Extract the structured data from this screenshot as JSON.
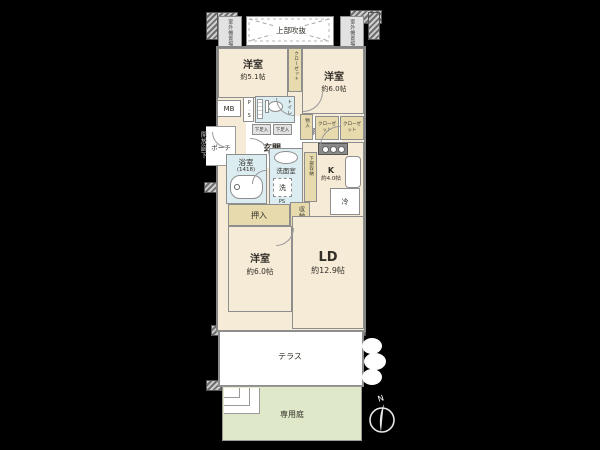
{
  "colors": {
    "background": "#000000",
    "room_floor": "#f6ebd7",
    "wet_area": "#dcedf2",
    "storage": "#e7dbae",
    "garden": "#dfe9c9",
    "terrace": "#ffffff",
    "wall": "#8e8e8e",
    "outside_text": "#c8c8c8"
  },
  "exterior": {
    "open_corridor": "開放廊下",
    "outdoor_unit_left": "室外機置場",
    "outdoor_unit_right": "室外機置場",
    "upper_void": "上部吹抜",
    "compass_north": "N"
  },
  "rooms": {
    "bedroom_51": {
      "name": "洋室",
      "area": "約5.1帖"
    },
    "bedroom_60_top": {
      "name": "洋室",
      "area": "約6.0帖"
    },
    "bedroom_60_bottom": {
      "name": "洋室",
      "area": "約6.0帖"
    },
    "living_dining": {
      "name": "LD",
      "area": "約12.9帖"
    },
    "kitchen": {
      "name": "K",
      "area": "約4.0帖"
    },
    "bathroom": {
      "name": "浴室",
      "size": "(1418)"
    },
    "washroom": "洗面室",
    "toilet": "トイレ",
    "entrance": "玄関",
    "hallway": "廊下",
    "porch": "ポーチ",
    "terrace": "テラス",
    "private_garden": "専用庭"
  },
  "fixtures": {
    "meter_box": "MB",
    "pipe_space_1": "P.S",
    "pipe_space_2": "PS",
    "washer": "洗",
    "refrigerator": "冷",
    "shoe_box_1": "下足入",
    "shoe_box_2": "下足入"
  },
  "storage": {
    "closet_top": "クローゼット",
    "closet_a": "クローゼット",
    "closet_b": "クローゼット",
    "monoire": "物入",
    "lower_storage": "下部収納",
    "oshiire": "押入",
    "shuno": "収納"
  }
}
